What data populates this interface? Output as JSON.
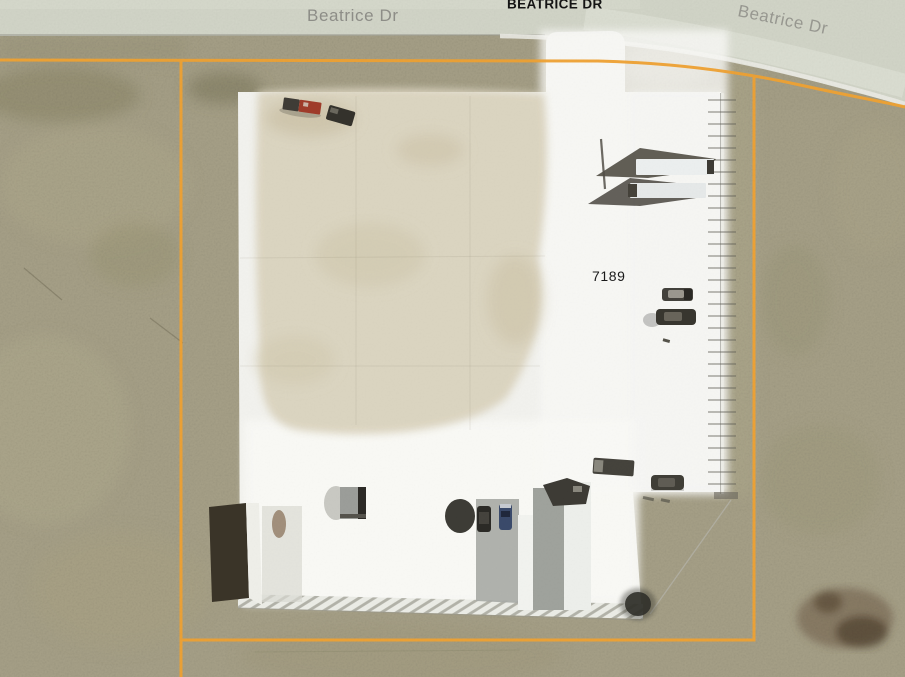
{
  "map": {
    "description": "Aerial parcel map of commercial lot on Beatrice Dr",
    "road_labels": [
      {
        "id": "left",
        "text": "Beatrice Dr"
      },
      {
        "id": "center",
        "text": "BEATRICE DR"
      },
      {
        "id": "right",
        "text": "Beatrice Dr"
      }
    ],
    "parcel_label": "7189",
    "colors": {
      "parcel_boundary": "#F0A232",
      "road_surface": "#D3D6C9",
      "grass": "#A8A289",
      "concrete_pad": "#F3F3EF",
      "dirt_patch": "#DBD4BF",
      "road_label_text": "#8D8D87",
      "parcel_label_text": "#1A1A1A"
    }
  }
}
